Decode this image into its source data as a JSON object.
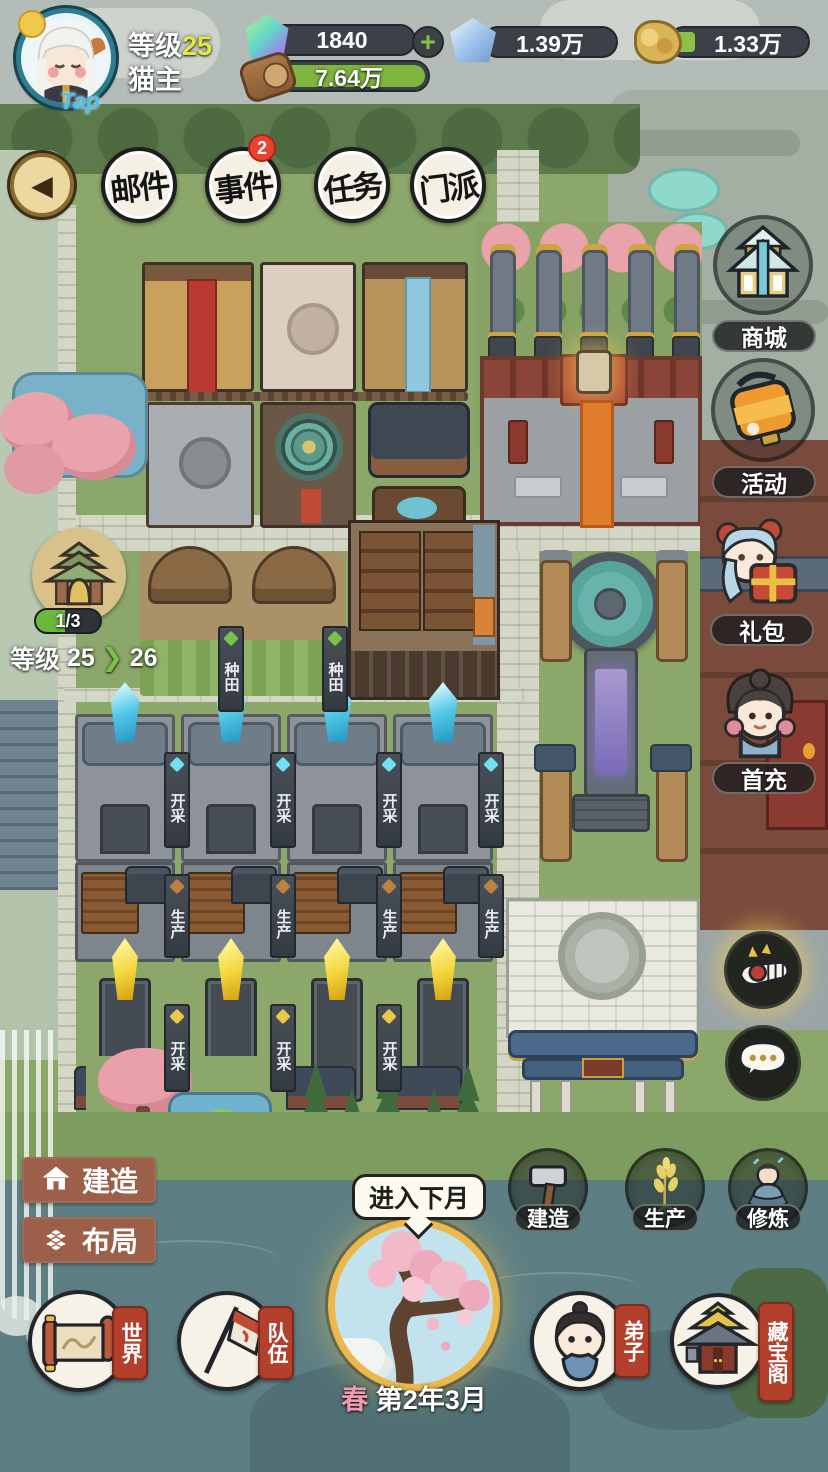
{
  "player": {
    "tap_label": "Tap",
    "level_prefix": "等级",
    "level": "25",
    "name": "猫主"
  },
  "resources": {
    "crystal": {
      "value": "1840",
      "plus": "+"
    },
    "jade": {
      "value": "1.39万"
    },
    "gold": {
      "value": "1.33万"
    },
    "wood": {
      "value": "7.64万"
    }
  },
  "top_menu": {
    "items": [
      {
        "label": "邮件"
      },
      {
        "label": "事件",
        "badge": "2"
      },
      {
        "label": "任务"
      },
      {
        "label": "门派"
      }
    ]
  },
  "right_menu": {
    "shop": "商城",
    "activity": "活动",
    "gift": "礼包",
    "first_charge": "首充"
  },
  "sect_panel": {
    "progress": "1/3",
    "level_prefix": "等级",
    "level_from": "25",
    "arrow": "❯",
    "level_to": "26"
  },
  "edit_menu": {
    "build": "建造",
    "layout": "布局"
  },
  "map_labels": {
    "mine": "开采",
    "produce": "生产",
    "farm": "种田"
  },
  "bottom_bar": {
    "world": "世界",
    "team": "队伍",
    "next_month": "进入下月",
    "season": "春",
    "date": "第2年3月",
    "build": "建造",
    "produce": "生产",
    "cultivate": "修炼",
    "disciples": "弟子",
    "treasure": "藏宝阁"
  }
}
